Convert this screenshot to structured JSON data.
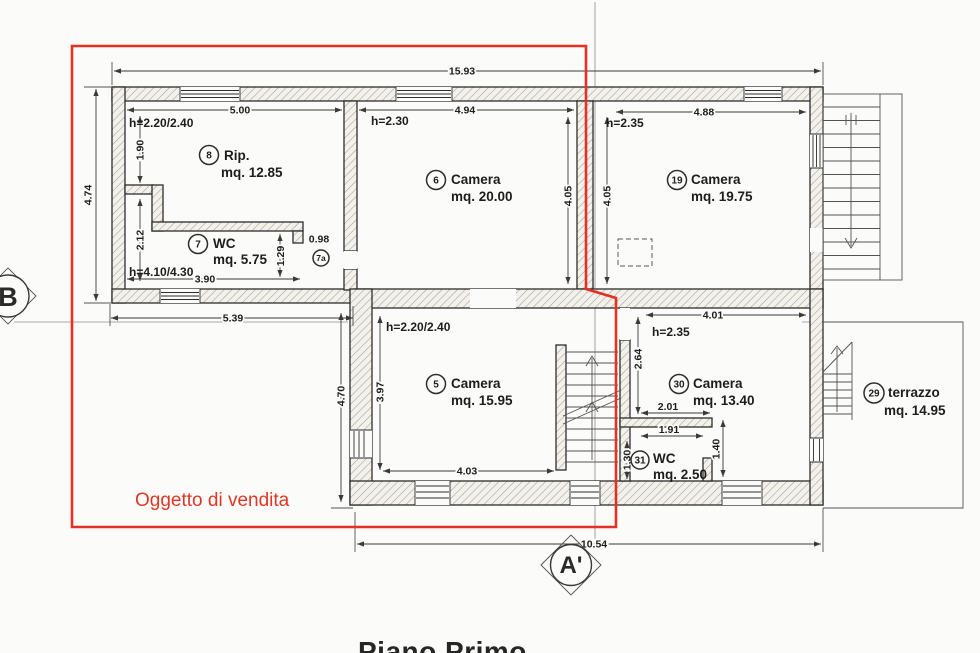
{
  "drawing": {
    "title": "Piano Primo",
    "annotation_label": "Oggetto di vendita",
    "annotation_color": "#e43122"
  },
  "markers": {
    "section_b": "B",
    "section_a": "A'"
  },
  "rooms": {
    "r8": {
      "num": "8",
      "name": "Rip.",
      "area": "mq. 12.85",
      "height": "h=2.20/2.40"
    },
    "r7": {
      "num": "7",
      "name": "WC",
      "area": "mq. 5.75",
      "height": "h=4.10/4.30"
    },
    "r7a": {
      "num": "7a"
    },
    "r6": {
      "num": "6",
      "name": "Camera",
      "area": "mq. 20.00",
      "height": "h=2.30"
    },
    "r19": {
      "num": "19",
      "name": "Camera",
      "area": "mq. 19.75",
      "height": "h=2.35"
    },
    "r5": {
      "num": "5",
      "name": "Camera",
      "area": "mq. 15.95",
      "height": "h=2.20/2.40"
    },
    "r30": {
      "num": "30",
      "name": "Camera",
      "area": "mq. 13.40",
      "height": "h=2.35"
    },
    "r31": {
      "num": "31",
      "name": "WC",
      "area": "mq. 2.50"
    },
    "r29": {
      "num": "29",
      "name": "terrazzo",
      "area": "mq. 14.95"
    }
  },
  "dims": {
    "top_total": "15.93",
    "left_total": "4.74",
    "r8_width": "5.00",
    "r8_upper": "1.90",
    "r8_lower": "2.12",
    "r6_width": "4.94",
    "r6_height": "4.05",
    "r19_left": "4.05",
    "r19_width": "4.88",
    "wc_width": "3.90",
    "wc_niche": "1.29",
    "niche_width": "0.98",
    "left_block": "5.39",
    "lower_left": "4.70",
    "r5_height": "3.97",
    "r5_width": "4.03",
    "r30_left": "2.64",
    "r30_width": "4.01",
    "r30_inner": "2.01",
    "r30_inner2": "1.91",
    "r30_door": "1.40",
    "r31_height": "1.30",
    "bottom_total": "10.54"
  }
}
